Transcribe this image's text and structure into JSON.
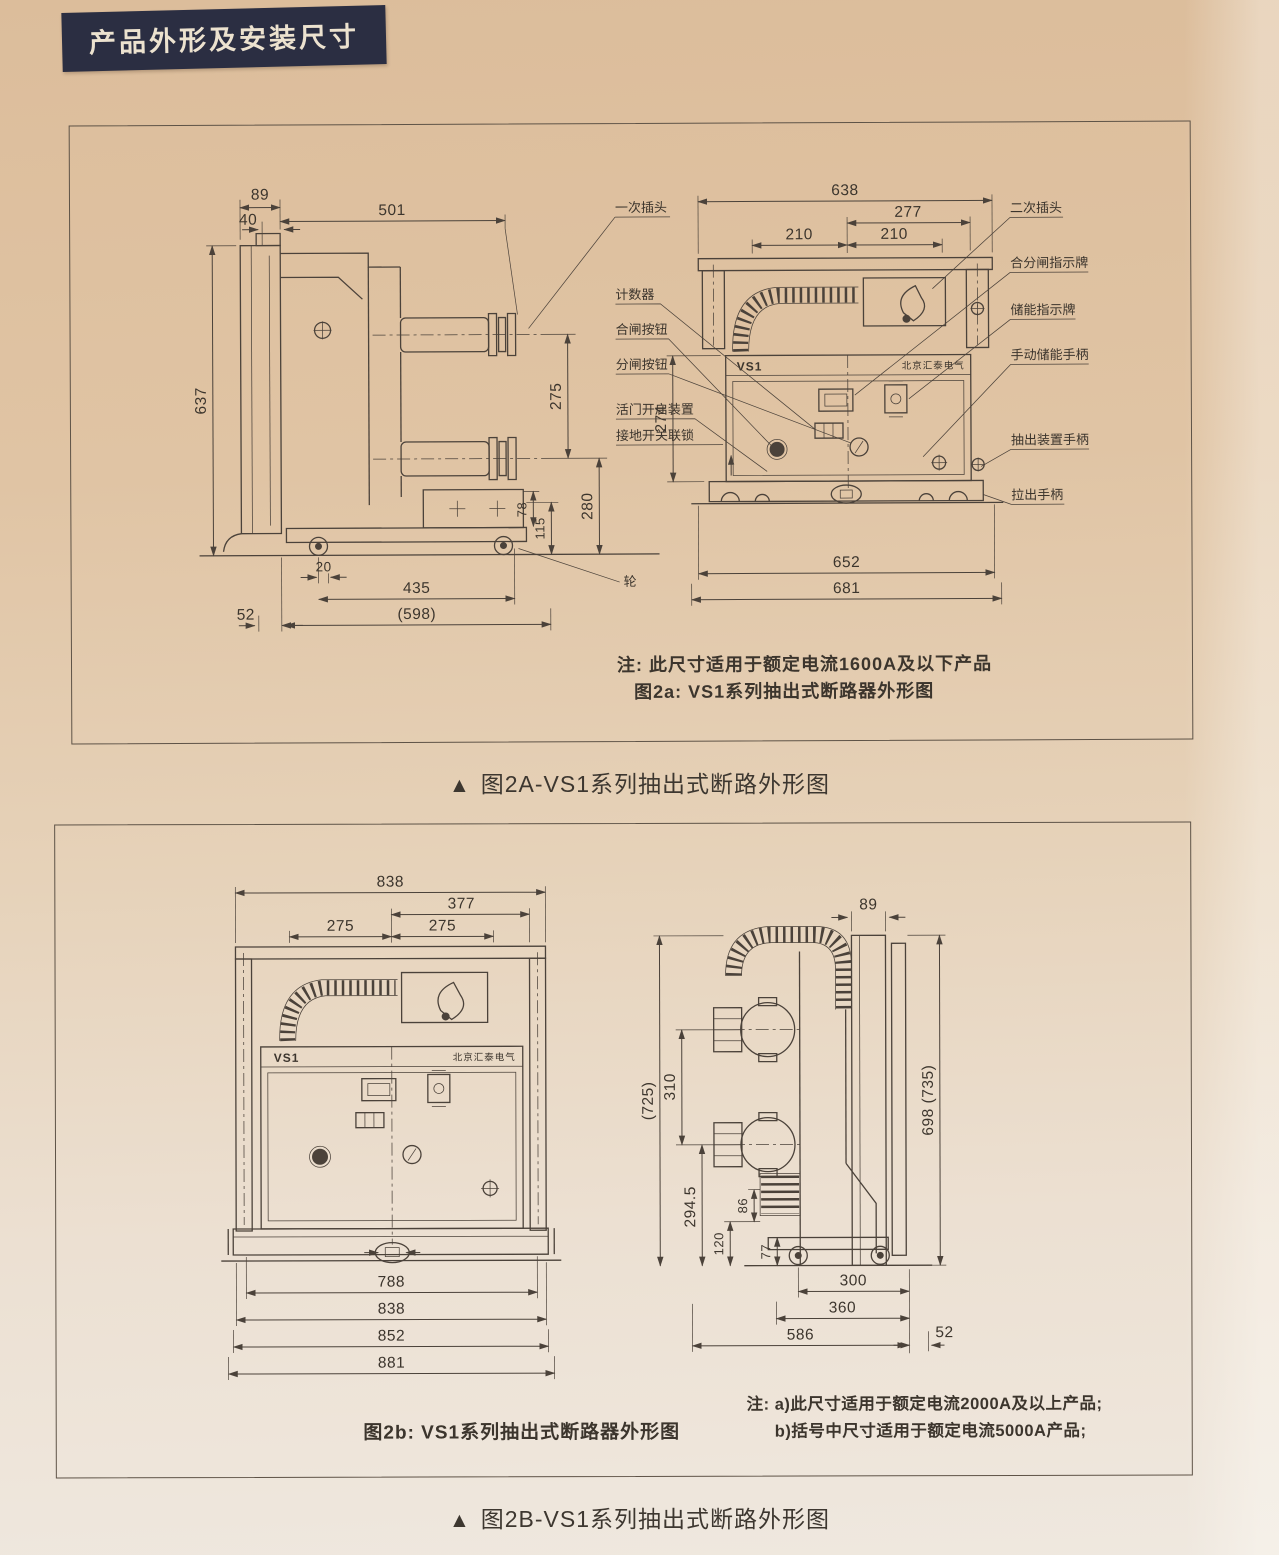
{
  "page": {
    "header": "产品外形及安装尺寸",
    "caption_marker": "▲",
    "caption_2a": "图2A-VS1系列抽出式断路外形图",
    "caption_2b": "图2B-VS1系列抽出式断路外形图",
    "colors": {
      "paper_top": "#ddbd9c",
      "paper_bottom": "#ece4da",
      "ink": "#4b423a",
      "badge_bg": "#2b2e42",
      "badge_text": "#ece2cf"
    }
  },
  "fig2a": {
    "note1": "注: 此尺寸适用于额定电流1600A及以下产品",
    "note2": "图2a: VS1系列抽出式断路器外形图",
    "wheel_label": "轮",
    "callouts_left": [
      "一次插头",
      "计数器",
      "合闸按钮",
      "分闸按钮",
      "活门开启装置",
      "接地开关联锁"
    ],
    "callouts_right": [
      "二次插头",
      "合分闸指示牌",
      "储能指示牌",
      "手动储能手柄",
      "抽出装置手柄",
      "拉出手柄"
    ],
    "side": {
      "dims": {
        "w89": "89",
        "w40": "40",
        "w501": "501",
        "h637": "637",
        "h275": "275",
        "h280": "280",
        "h78": "78",
        "h115": "115",
        "b20": "20",
        "b435": "435",
        "b598": "(598)",
        "b52": "52"
      }
    },
    "front": {
      "logo": "VS1",
      "brand": "北京汇泰电气",
      "dims": {
        "w638": "638",
        "w277": "277",
        "w210a": "210",
        "w210b": "210",
        "h274": "274",
        "b652": "652",
        "b681": "681"
      }
    }
  },
  "fig2b": {
    "label": "图2b: VS1系列抽出式断路器外形图",
    "note1": "注: a)此尺寸适用于额定电流2000A及以上产品;",
    "note2": "b)括号中尺寸适用于额定电流5000A产品;",
    "front": {
      "logo": "VS1",
      "brand": "北京汇泰电气",
      "dims": {
        "w838": "838",
        "w377": "377",
        "w275a": "275",
        "w275b": "275",
        "b788": "788",
        "b838": "838",
        "b852": "852",
        "b881": "881"
      }
    },
    "side": {
      "dims": {
        "w89": "89",
        "h725": "(725)",
        "h310": "310",
        "h2945": "294.5",
        "h86": "86",
        "h120": "120",
        "h77": "77",
        "h698": "698 (735)",
        "b300": "300",
        "b360": "360",
        "b586": "586",
        "b52": "52"
      }
    }
  }
}
